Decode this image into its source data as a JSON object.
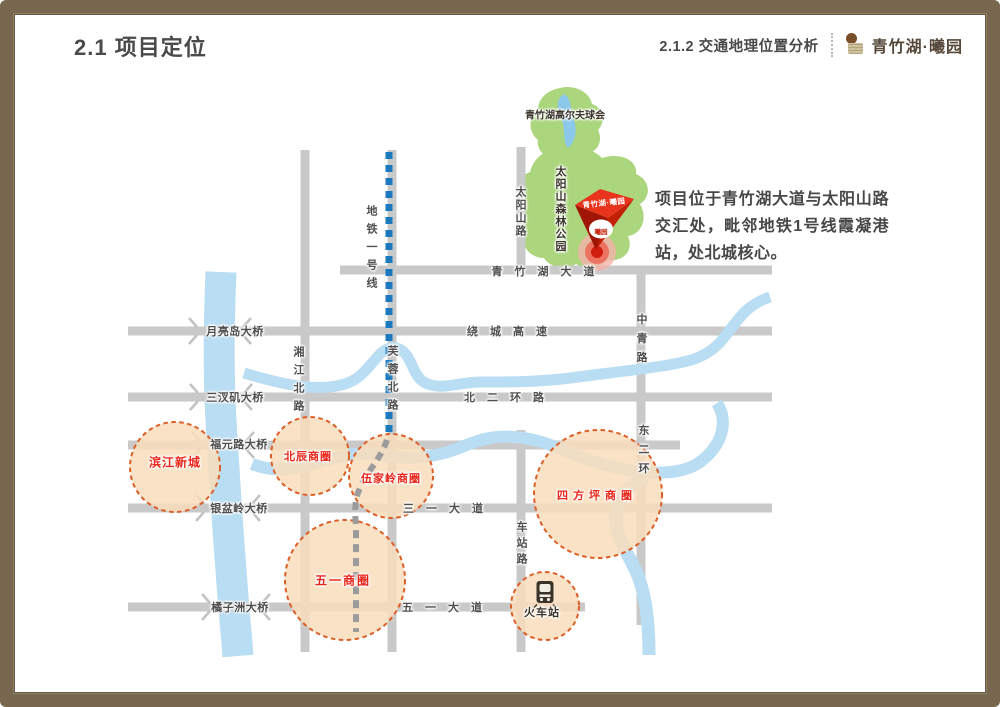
{
  "header": {
    "title": "2.1 项目定位",
    "section": "2.1.2 交通地理位置分析",
    "brand": "青竹湖·曦园"
  },
  "description": "项目位于青竹湖大道与太阳山路交汇处，毗邻地铁1号线霞凝港站，处北城核心。",
  "map": {
    "parks": {
      "golf": "青竹湖高尔夫球会",
      "forest": "太阳山森林公园"
    },
    "pin": {
      "title": "青竹湖·曦园",
      "logo": "曦园"
    },
    "metro": {
      "label": "地铁一号线"
    },
    "roads": {
      "qingzhuhu": "青竹湖大道",
      "raocheng": "绕城高速",
      "beierhuan": "北二环路",
      "sanyi": "三一大道",
      "wuyi": "五一大道",
      "taiyangshan": "太阳山路",
      "xiangjiang": "湘江北路",
      "furong": "芙蓉北路",
      "zhongqing": "中青路",
      "dongerhuan": "东二环",
      "chezhan": "车站路"
    },
    "bridges": {
      "yueliangdao": "月亮岛大桥",
      "sanchaji": "三汊矶大桥",
      "fuyuanlu": "福元路大桥",
      "yinpenling": "银盆岭大桥",
      "juzizhou": "橘子洲大桥"
    },
    "districts": {
      "binjiang": "滨江新城",
      "beichen": "北辰商圈",
      "wujialing": "伍家岭商圈",
      "sifangping": "四方坪商圈",
      "wuyiquan": "五一商圈"
    },
    "station": "火车站"
  },
  "colors": {
    "frame_brown": "#77674f",
    "road_gray": "#c9c9c9",
    "river_blue": "#b9ddf3",
    "park_green": "#abd67d",
    "lake_blue": "#8cc8ea",
    "metro_blue": "#1b79c0",
    "metro_gray": "#9b9b9b",
    "circle_fill": "#f8ddbb",
    "circle_stroke": "#dd5f28",
    "district_red": "#e8261b",
    "pin_red": "#e8341c"
  }
}
